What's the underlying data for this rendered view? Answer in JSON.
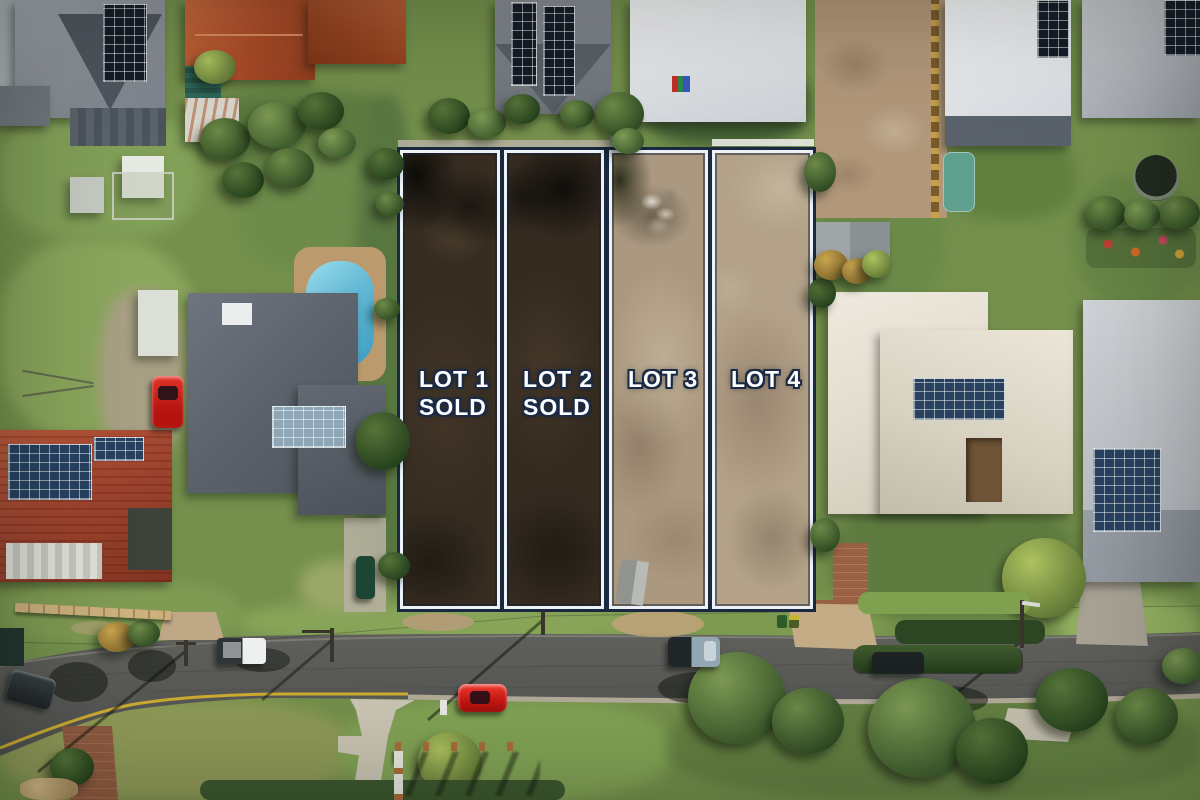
{
  "scene": {
    "description": "Aerial drone photograph of a four-lot residential land subdivision bounded by suburban houses, backyards with pools, and a curving street with parked cars",
    "street_edge_line_color": "#d4b22e"
  },
  "overlay": {
    "lots": [
      {
        "name": "Lot 1",
        "label": "LOT 1",
        "status": "SOLD",
        "sold": true
      },
      {
        "name": "Lot 2",
        "label": "LOT 2",
        "status": "SOLD",
        "sold": true
      },
      {
        "name": "Lot 3",
        "label": "LOT 3",
        "status": "",
        "sold": false
      },
      {
        "name": "Lot 4",
        "label": "LOT 4",
        "status": "",
        "sold": false
      }
    ],
    "boundary_outer_color": "#1a2840",
    "boundary_inner_color": "#edf2f7",
    "label_text_color": "#fdfeff",
    "label_outline_color": "#1b2a45",
    "sold_lot_ground_tone": "#362c21",
    "available_lot_ground_tone": "#ab9880"
  }
}
